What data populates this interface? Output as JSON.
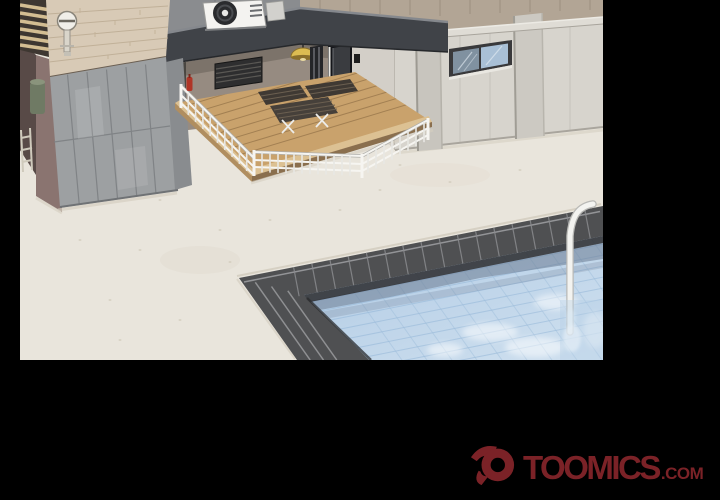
{
  "scene": {
    "type": "webtoon-panel",
    "description": "3D-rendered rooftop scene: building with wooden terrace deck and white railing, air-conditioner on a dark beam, concrete walls with a slit window, and a blue swimming pool with a white ladder, all framed by black borders",
    "objects": [
      "wood-slat-screen",
      "stone-wall",
      "shower-fixture",
      "concrete-panel-wall",
      "gas-cylinder",
      "small-ladder",
      "roof-beam",
      "ac-unit",
      "vent-grille",
      "ceiling-lamp",
      "glass-panel",
      "door",
      "corner-wall",
      "upper-wall-band",
      "roof-fascia",
      "right-wall",
      "pilasters",
      "slit-window",
      "deck-platform",
      "bench-left",
      "bench-right",
      "picnic-table",
      "white-railing",
      "fire-extinguisher",
      "pool-border",
      "pool-water",
      "pool-ladder"
    ]
  },
  "watermark": {
    "brand": "TOOMICS",
    "suffix": ".COM"
  },
  "colors": {
    "frame": "#000000",
    "floor": "#e9e5dc",
    "stone_wall": "#d8cab6",
    "concrete_wall": "#9da0a2",
    "mauve_wall": "#8a7470",
    "beam": "#404348",
    "terrace_wall": "#968b81",
    "deck_wood": "#c9a26c",
    "right_wall": "#d7d4cd",
    "upper_band": "#b2a595",
    "pool_border": "#4f5052",
    "water": "#bcd3e8",
    "lamp": "#dcbc52",
    "logo_red": "#7b2227"
  }
}
